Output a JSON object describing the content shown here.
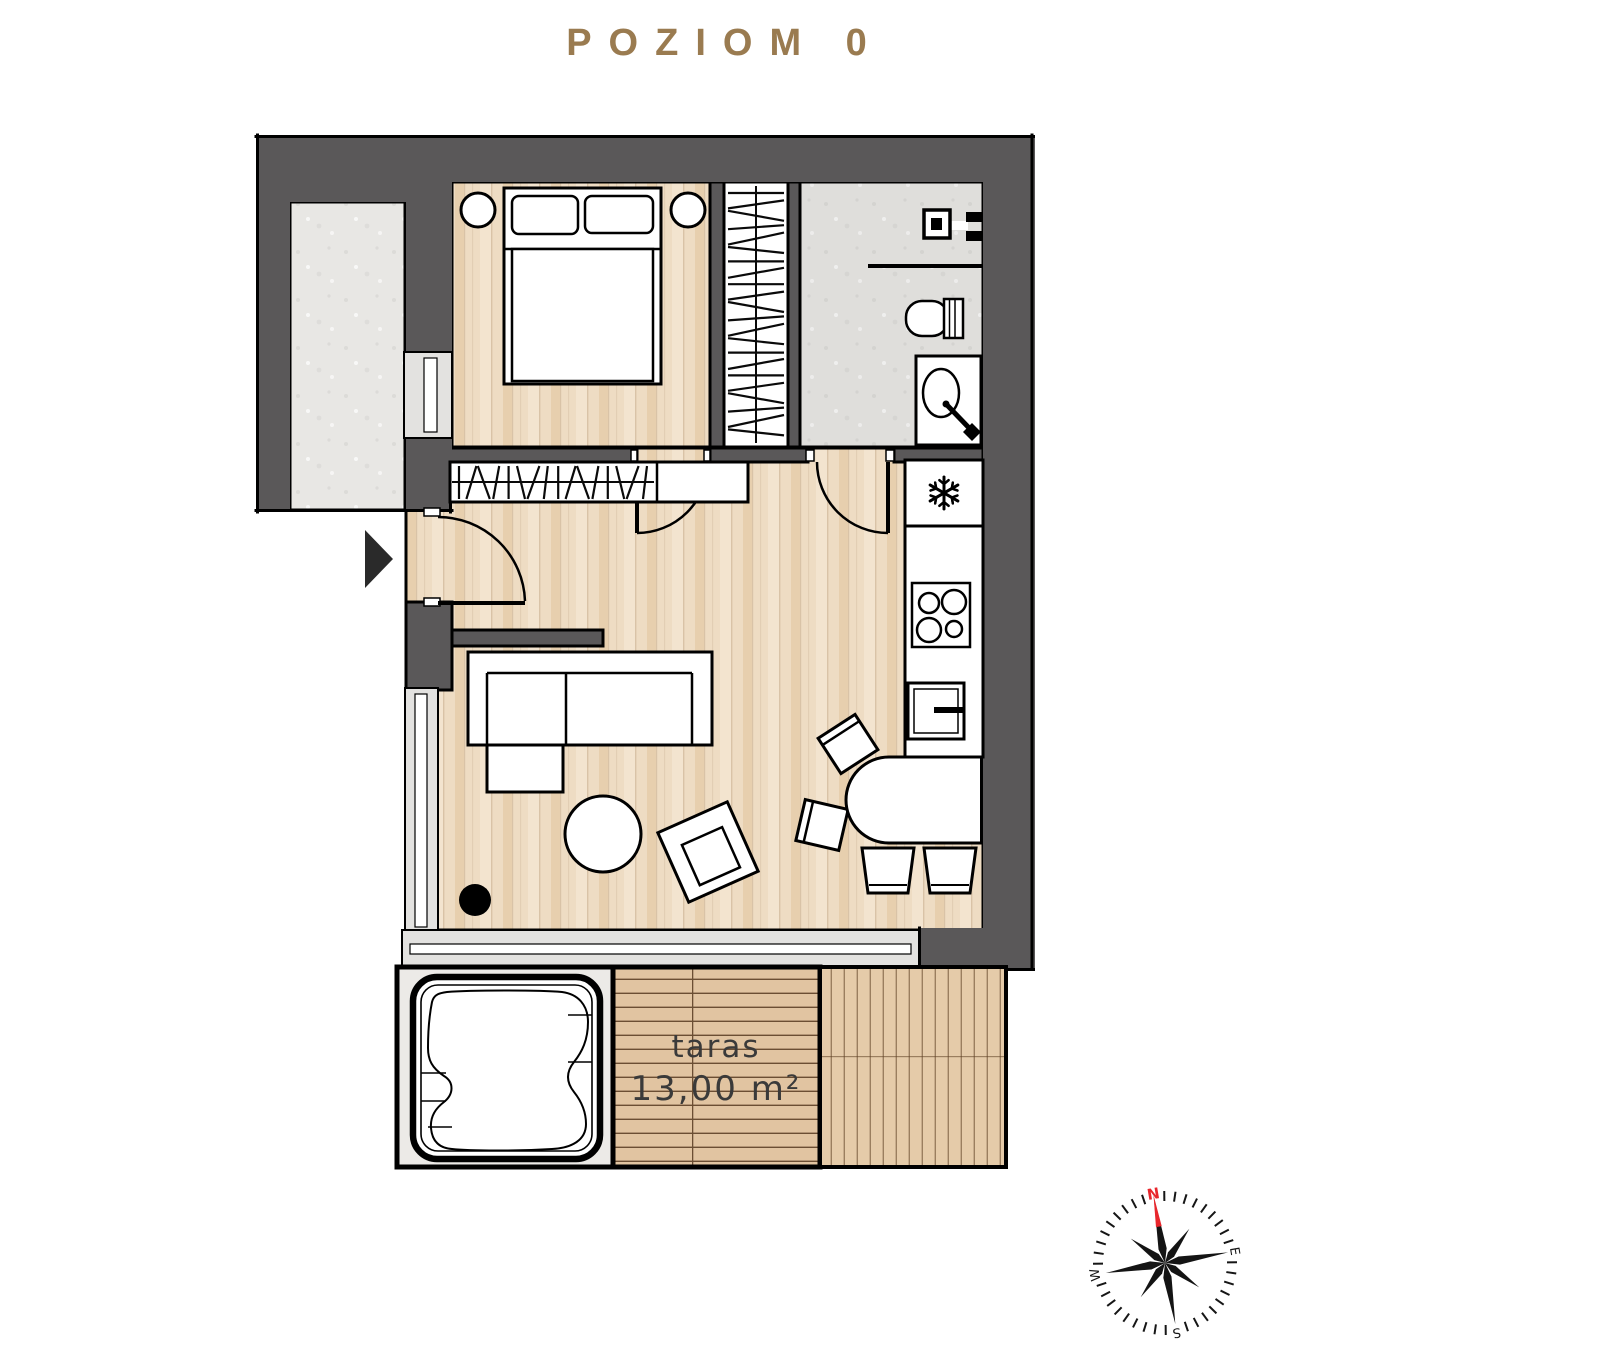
{
  "title": "POZIOM 0",
  "terrace": {
    "label": "taras",
    "area": "13,00 m²"
  },
  "compass": {
    "north": "N",
    "east": "E",
    "south": "S",
    "west": "W"
  },
  "colors": {
    "accent": "#9A7B50",
    "wall": "#5A5859",
    "plan_line": "#000000",
    "wood_base": "#EEDCC3",
    "wood_light": "#F3E4CF",
    "wood_dark": "#E7CFAE",
    "deck_base": "#E1C4A1",
    "deck_line": "#6B4E33",
    "deck_right": "#E5CBA9",
    "concrete": "#E8E7E4",
    "window_glass": "#E3E2E0",
    "text_dark": "#3A3A3A",
    "compass_red": "#E8262C",
    "tub_bg": "#ECEAE7"
  },
  "icons": {
    "fridge": "snowflake-icon",
    "entrance": "entrance-arrow-icon",
    "compass": "compass-rose-icon"
  }
}
